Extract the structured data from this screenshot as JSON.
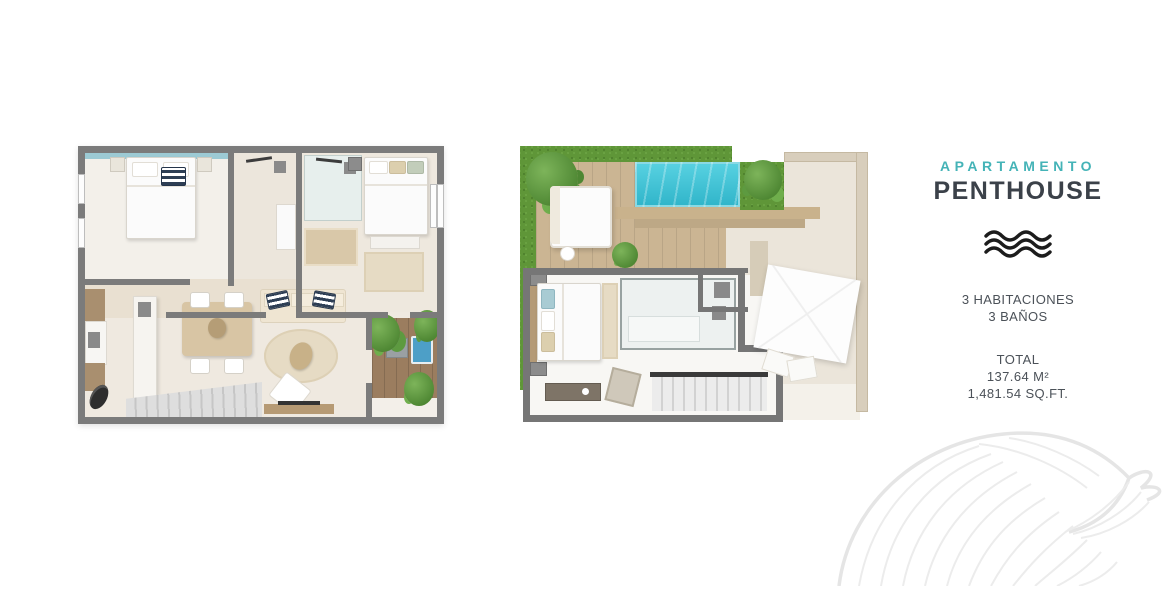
{
  "panel": {
    "category": "APARTAMENTO",
    "title": "PENTHOUSE",
    "features": {
      "bedrooms": "3 HABITACIONES",
      "bathrooms": "3 BAÑOS"
    },
    "total": {
      "label": "TOTAL",
      "area_m2": "137.64 M²",
      "area_sqft": "1,481.54 SQ.FT."
    }
  },
  "icons": {
    "waves": "waves-icon",
    "shell": "shell-line-art"
  },
  "colors": {
    "accent_teal": "#44b3b7",
    "heading_dark": "#3b4149",
    "body_text": "#4b5158",
    "wall_gray": "#7b7b7b",
    "pool_turquoise": "#3fc3d6",
    "hedge_green": "#5f9638",
    "deck_wood": "#cbb593",
    "balcony_wood": "#9b7d5f",
    "floor_light": "#efe9e0"
  }
}
